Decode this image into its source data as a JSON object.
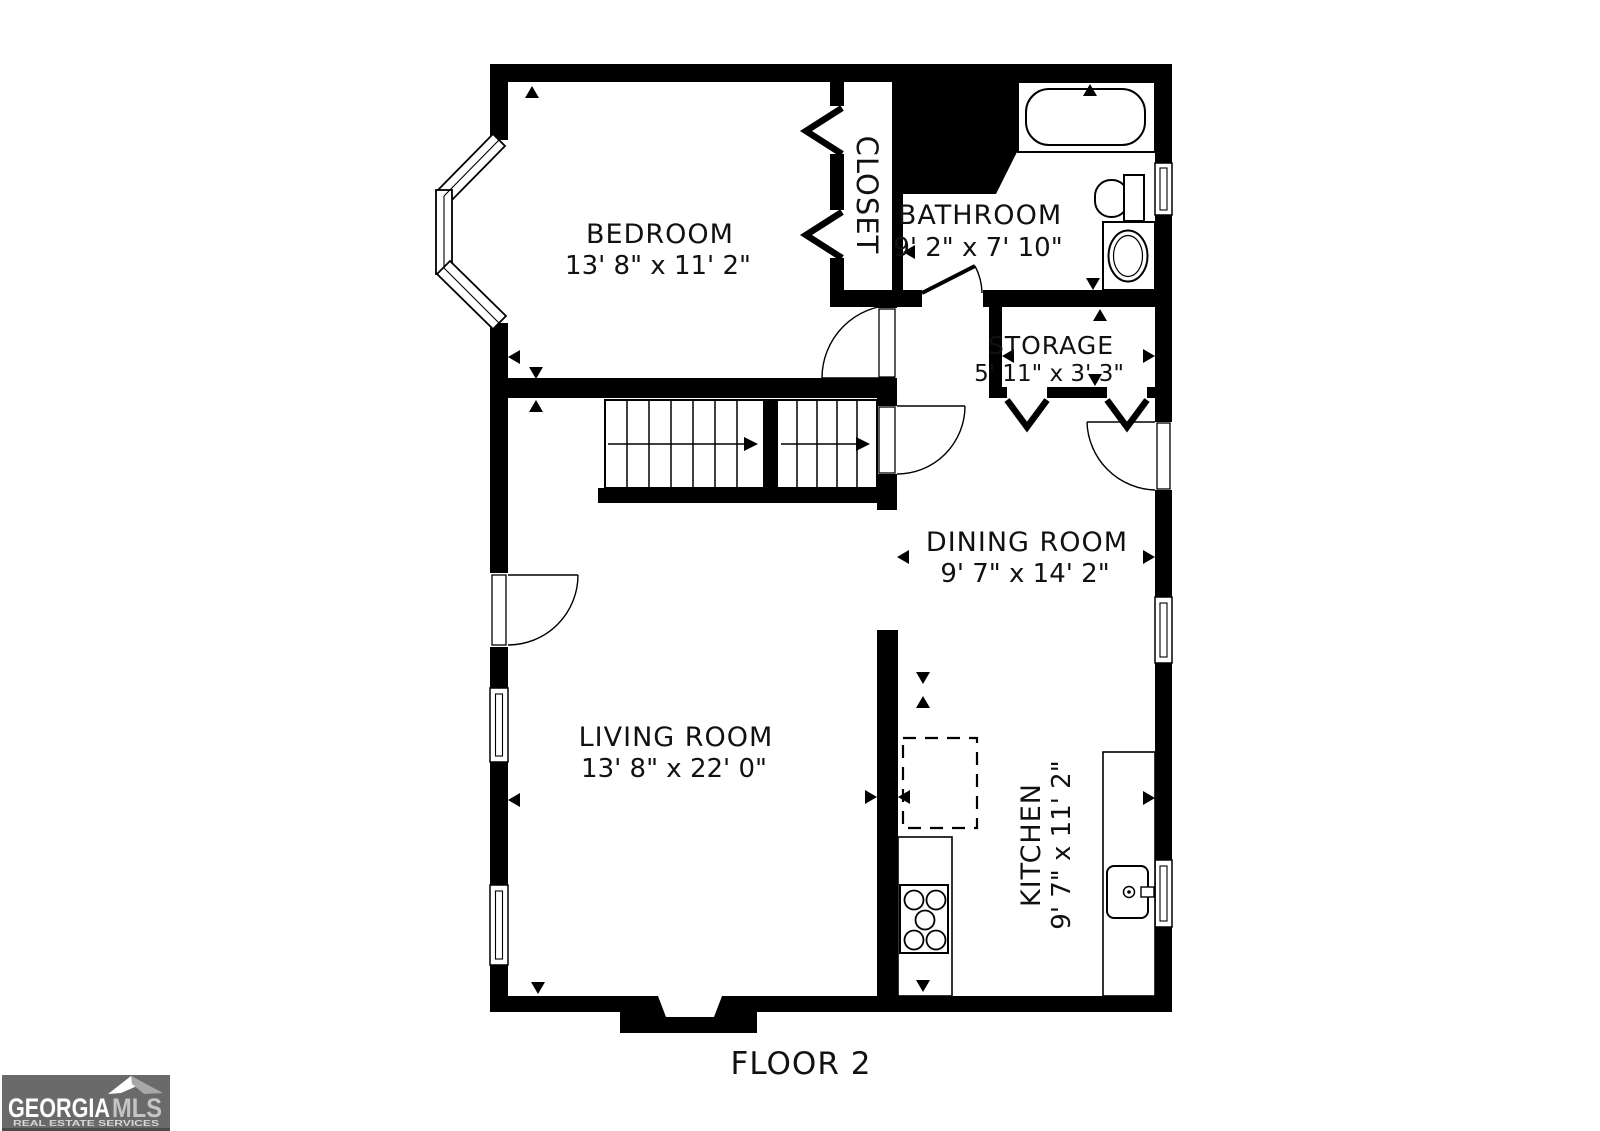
{
  "floor_label": "FLOOR 2",
  "colors": {
    "wall": "#000000",
    "background": "#ffffff",
    "label_text": "#111111",
    "logo_background": "#6a6a6a",
    "logo_primary_text": "#ffffff",
    "logo_secondary_text": "#c4c4c4",
    "logo_tagline_text": "#d8d8d8"
  },
  "rooms": [
    {
      "name": "BEDROOM",
      "dims": "13' 8\" x 11' 2\""
    },
    {
      "name": "CLOSET",
      "dims": ""
    },
    {
      "name": "BATHROOM",
      "dims": "9' 2\" x 7' 10\""
    },
    {
      "name": "STORAGE",
      "dims": "5' 11\" x 3' 3\""
    },
    {
      "name": "DINING ROOM",
      "dims": "9' 7\" x 14' 2\""
    },
    {
      "name": "LIVING ROOM",
      "dims": "13' 8\" x 22' 0\""
    },
    {
      "name": "KITCHEN",
      "dims": "9' 7\" x 11' 2\""
    }
  ],
  "logo": {
    "brand_primary": "GEORGIA",
    "brand_secondary": "MLS",
    "tagline": "REAL ESTATE SERVICES"
  }
}
